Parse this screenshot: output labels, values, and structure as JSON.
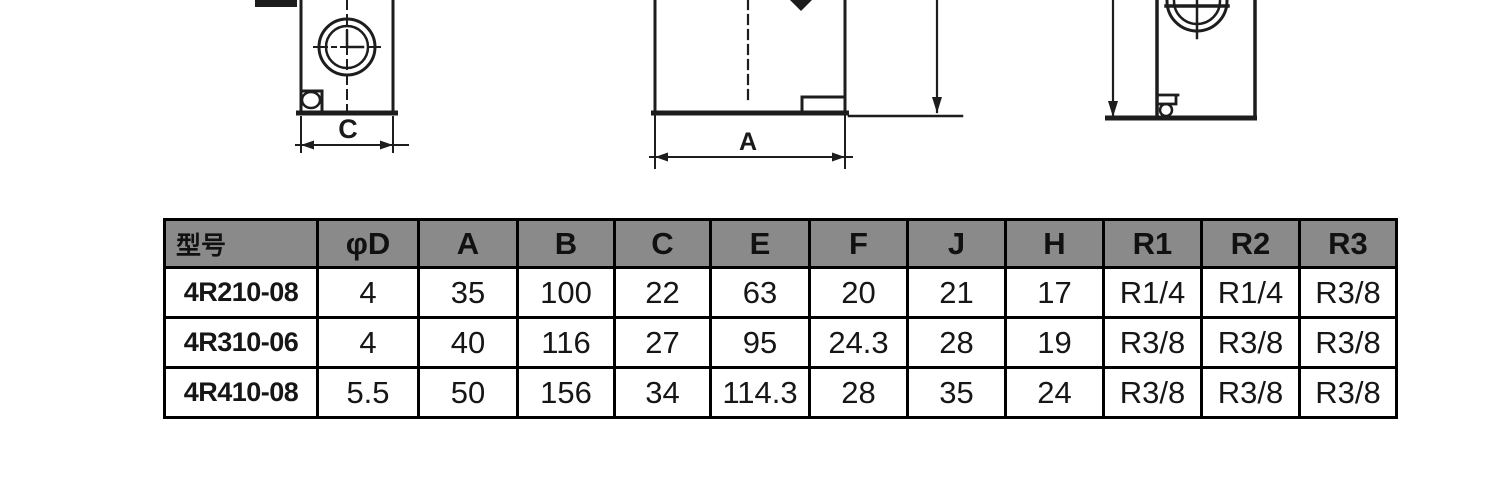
{
  "drawings": {
    "left_view": {
      "dim_label": "C"
    },
    "middle_view": {
      "dim_label": "A"
    }
  },
  "table": {
    "headers": [
      "型号",
      "φD",
      "A",
      "B",
      "C",
      "E",
      "F",
      "J",
      "H",
      "R1",
      "R2",
      "R3"
    ],
    "rows": [
      {
        "model": "4R210-08",
        "values": [
          "4",
          "35",
          "100",
          "22",
          "63",
          "20",
          "21",
          "17",
          "R1/4",
          "R1/4",
          "R3/8"
        ]
      },
      {
        "model": "4R310-06",
        "values": [
          "4",
          "40",
          "116",
          "27",
          "95",
          "24.3",
          "28",
          "19",
          "R3/8",
          "R3/8",
          "R3/8"
        ]
      },
      {
        "model": "4R410-08",
        "values": [
          "5.5",
          "50",
          "156",
          "34",
          "114.3",
          "28",
          "35",
          "24",
          "R3/8",
          "R3/8",
          "R3/8"
        ]
      }
    ]
  },
  "colors": {
    "header_bg": "#8a8a8a",
    "line": "#1d1d1d",
    "table_border": "#000000",
    "background": "#ffffff"
  }
}
